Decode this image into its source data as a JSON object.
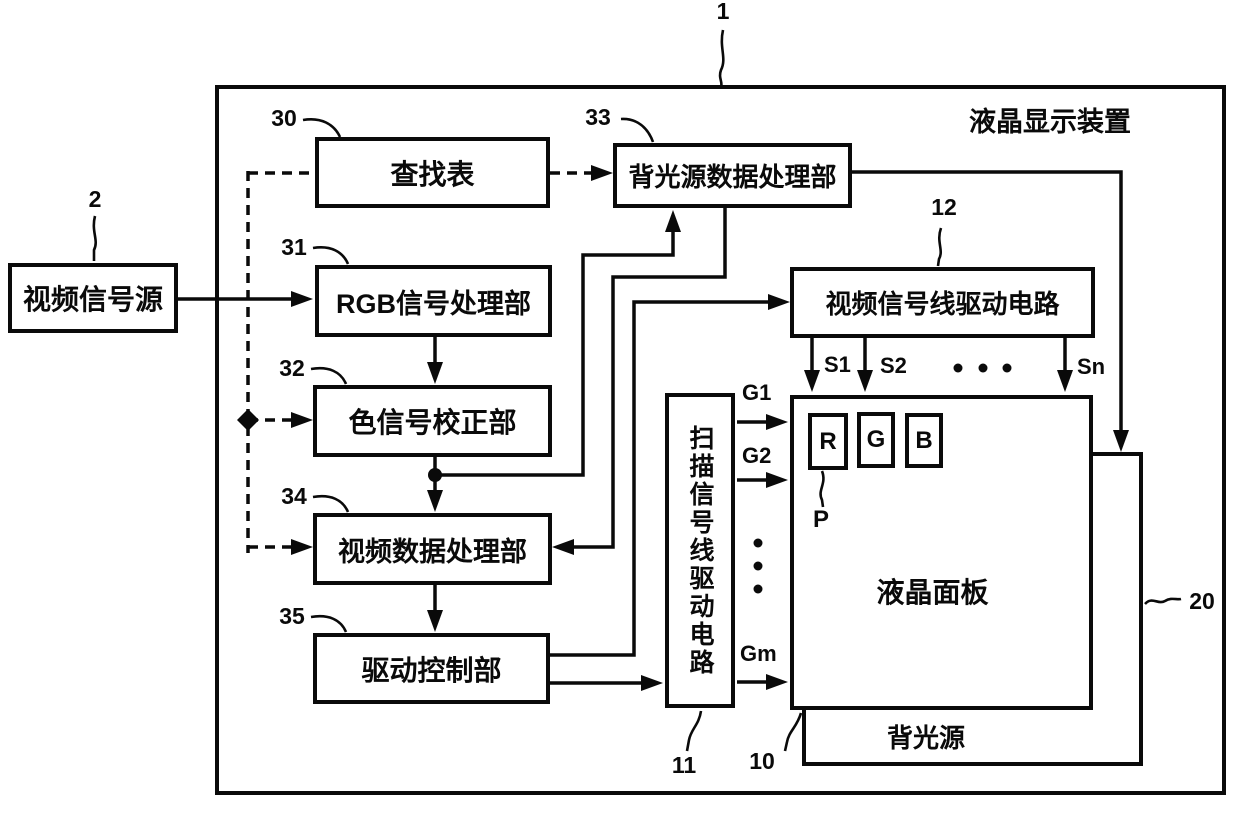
{
  "figure": {
    "device_ref": "1",
    "title": "液晶显示装置"
  },
  "boxes": {
    "source": {
      "ref": "2",
      "label": "视频信号源"
    },
    "lut": {
      "ref": "30",
      "label": "查找表"
    },
    "bl_data_proc": {
      "ref": "33",
      "label": "背光源数据处理部"
    },
    "rgb_proc": {
      "ref": "31",
      "label": "RGB信号处理部"
    },
    "color_corr": {
      "ref": "32",
      "label": "色信号校正部"
    },
    "video_proc": {
      "ref": "34",
      "label": "视频数据处理部"
    },
    "drive_ctrl": {
      "ref": "35",
      "label": "驱动控制部"
    },
    "source_driver": {
      "ref": "12",
      "label": "视频信号线驱动电路"
    },
    "scan_driver": {
      "ref": "11",
      "label": "扫描信号线驱动电路"
    },
    "lcd_panel": {
      "ref": "10",
      "label": "液晶面板"
    },
    "backlight": {
      "ref": "20",
      "label": "背光源"
    }
  },
  "signals": {
    "s1": "S1",
    "s2": "S2",
    "sn": "Sn",
    "g1": "G1",
    "g2": "G2",
    "gm": "Gm",
    "pixel_ref": "P",
    "sub_r": "R",
    "sub_g": "G",
    "sub_b": "B"
  },
  "colors": {
    "ink": "#0a0a0a",
    "paper": "#ffffff"
  }
}
